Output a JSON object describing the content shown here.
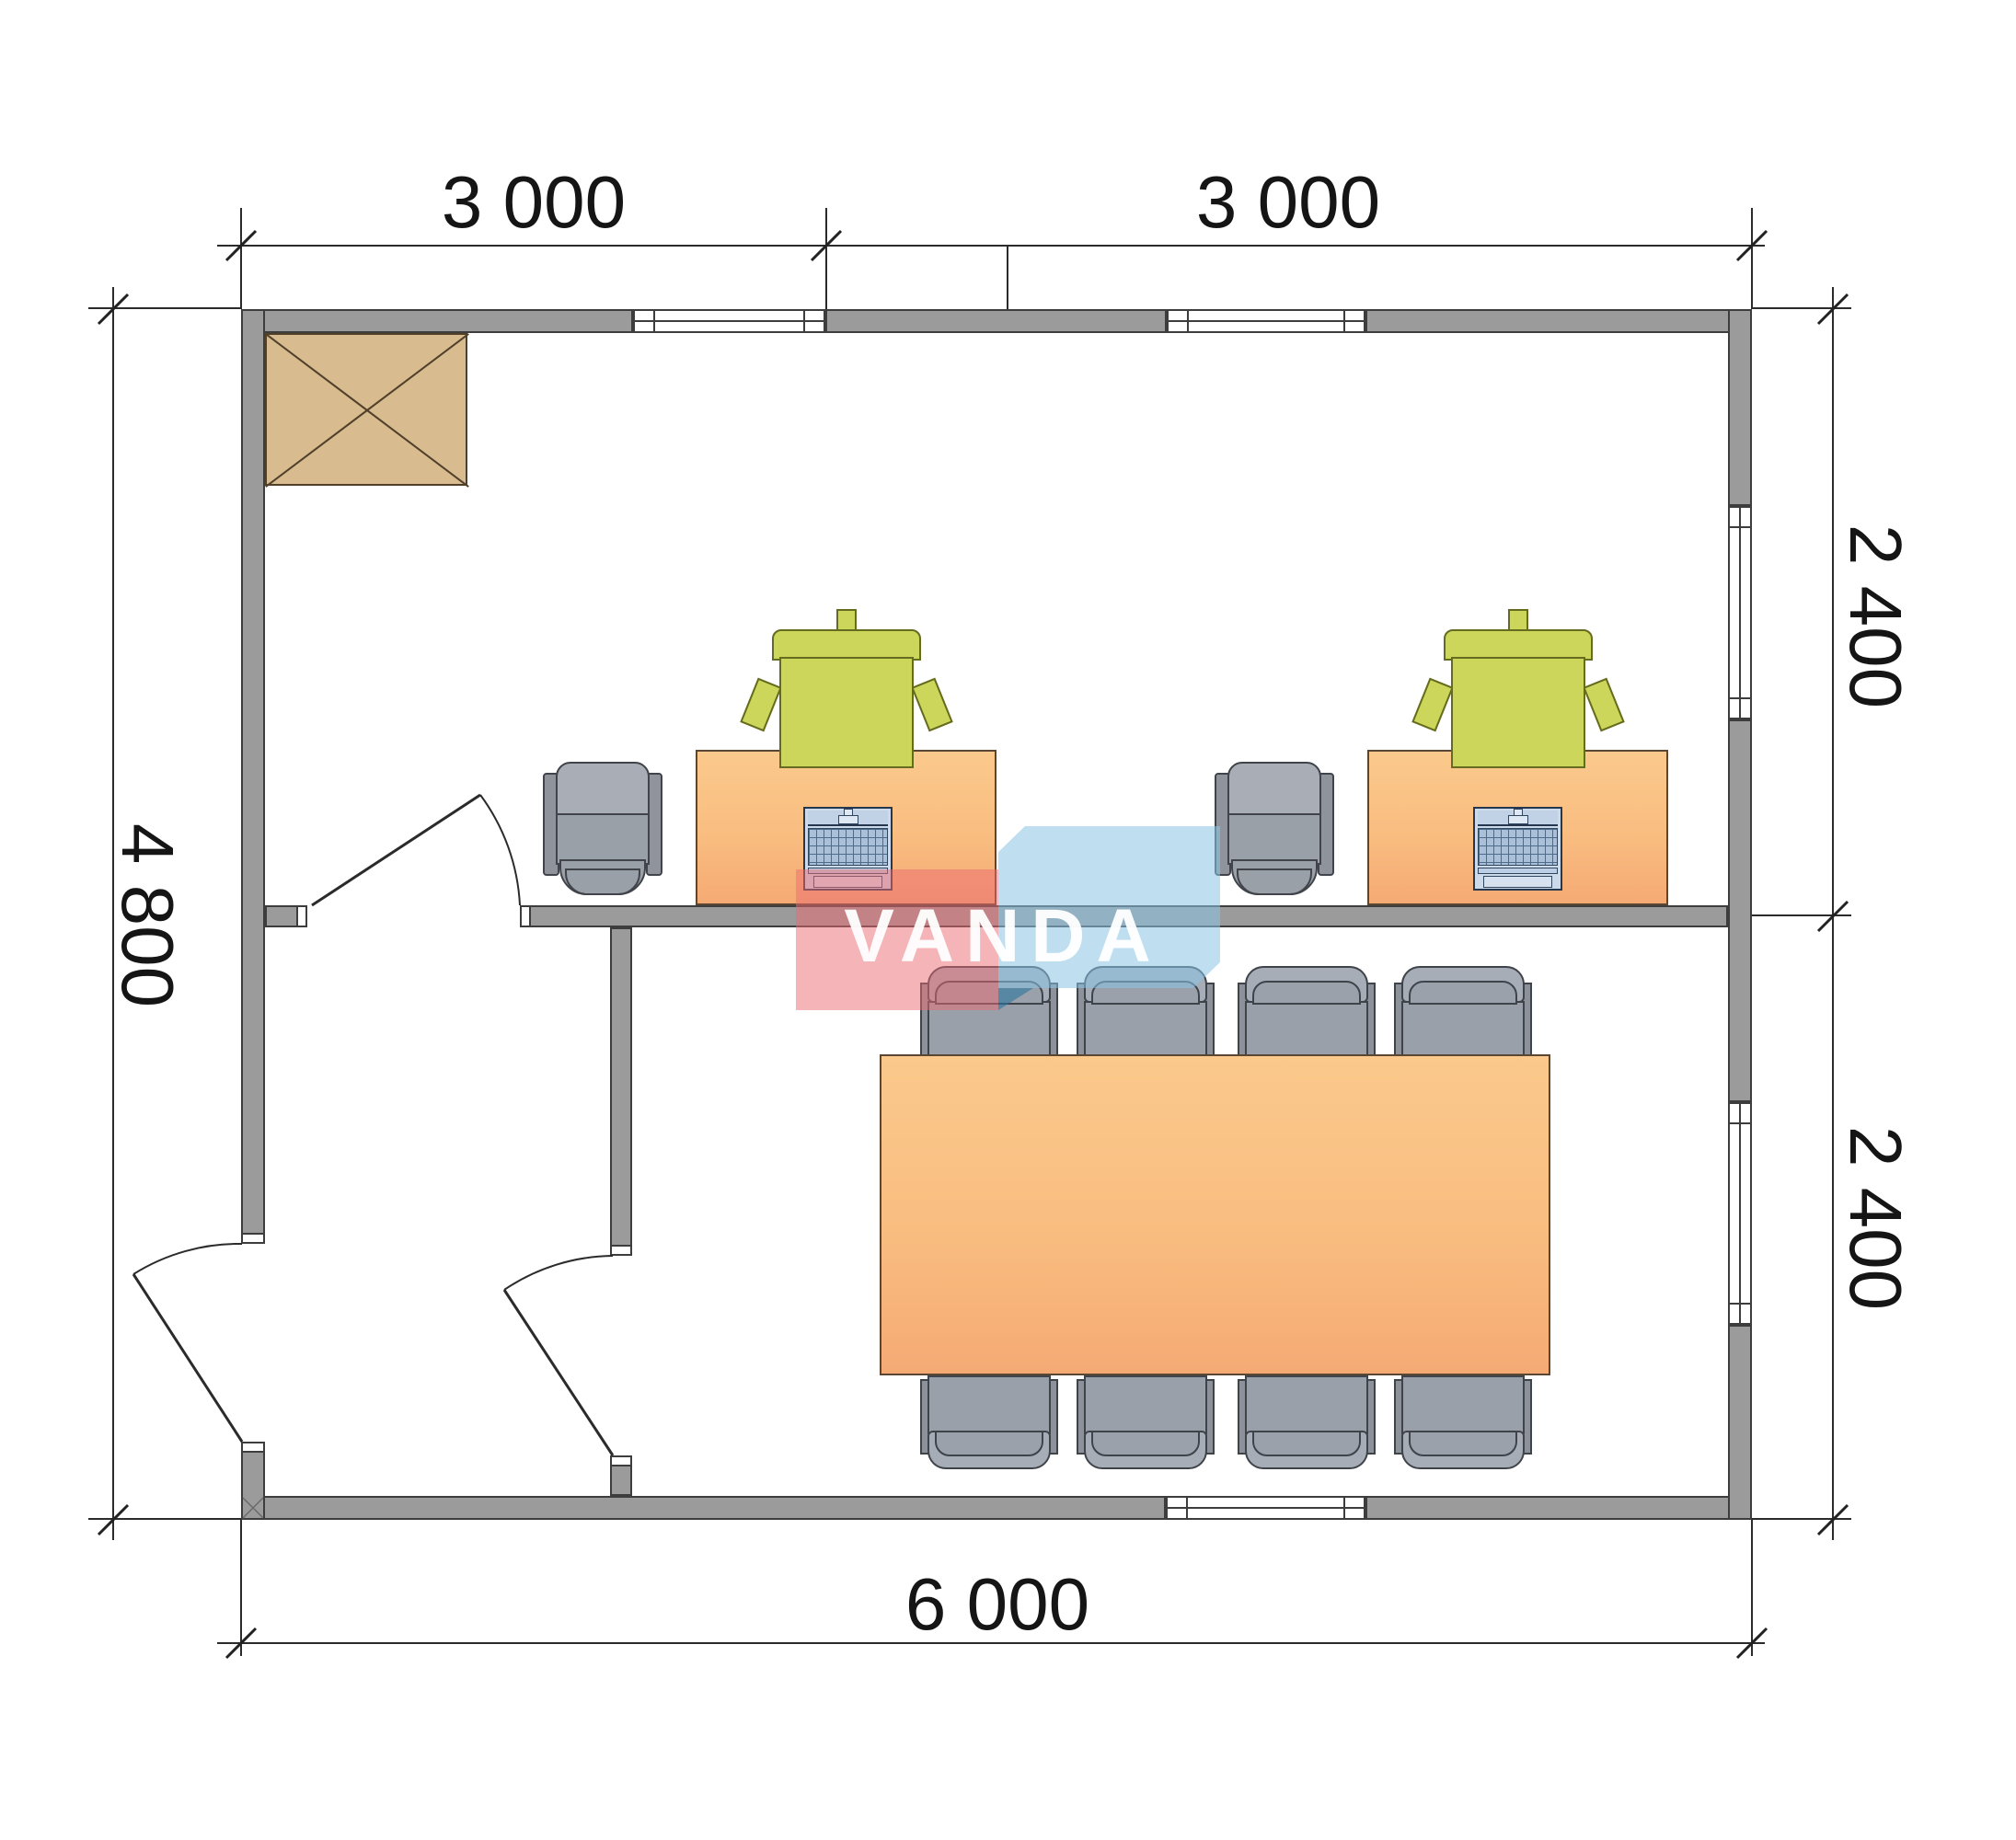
{
  "dimensions": {
    "top_left": "3 000",
    "top_right": "3 000",
    "left": "4 800",
    "right_upper": "2 400",
    "right_lower": "2 400",
    "bottom": "6 000"
  },
  "logo": {
    "text": "VANDA",
    "pink_color": "#ec6c72",
    "blue_color": "#8bc4e6"
  },
  "plan": {
    "building_outline_mm": {
      "width": "6000",
      "height": "4800"
    },
    "wall_color": "#9b9b9b",
    "desk_color": "#f9bd80",
    "cabinet_color": "#d8bb8f",
    "task_chair_color": "#ccd65a",
    "office_chair_color": "#9aa0a8",
    "rooms": [
      "office-room-top",
      "hallway-bottom-left",
      "meeting-room-bottom-right"
    ],
    "windows": 5,
    "doors": 3,
    "desks": 2,
    "laptops": 2,
    "meeting_chairs": 8
  }
}
